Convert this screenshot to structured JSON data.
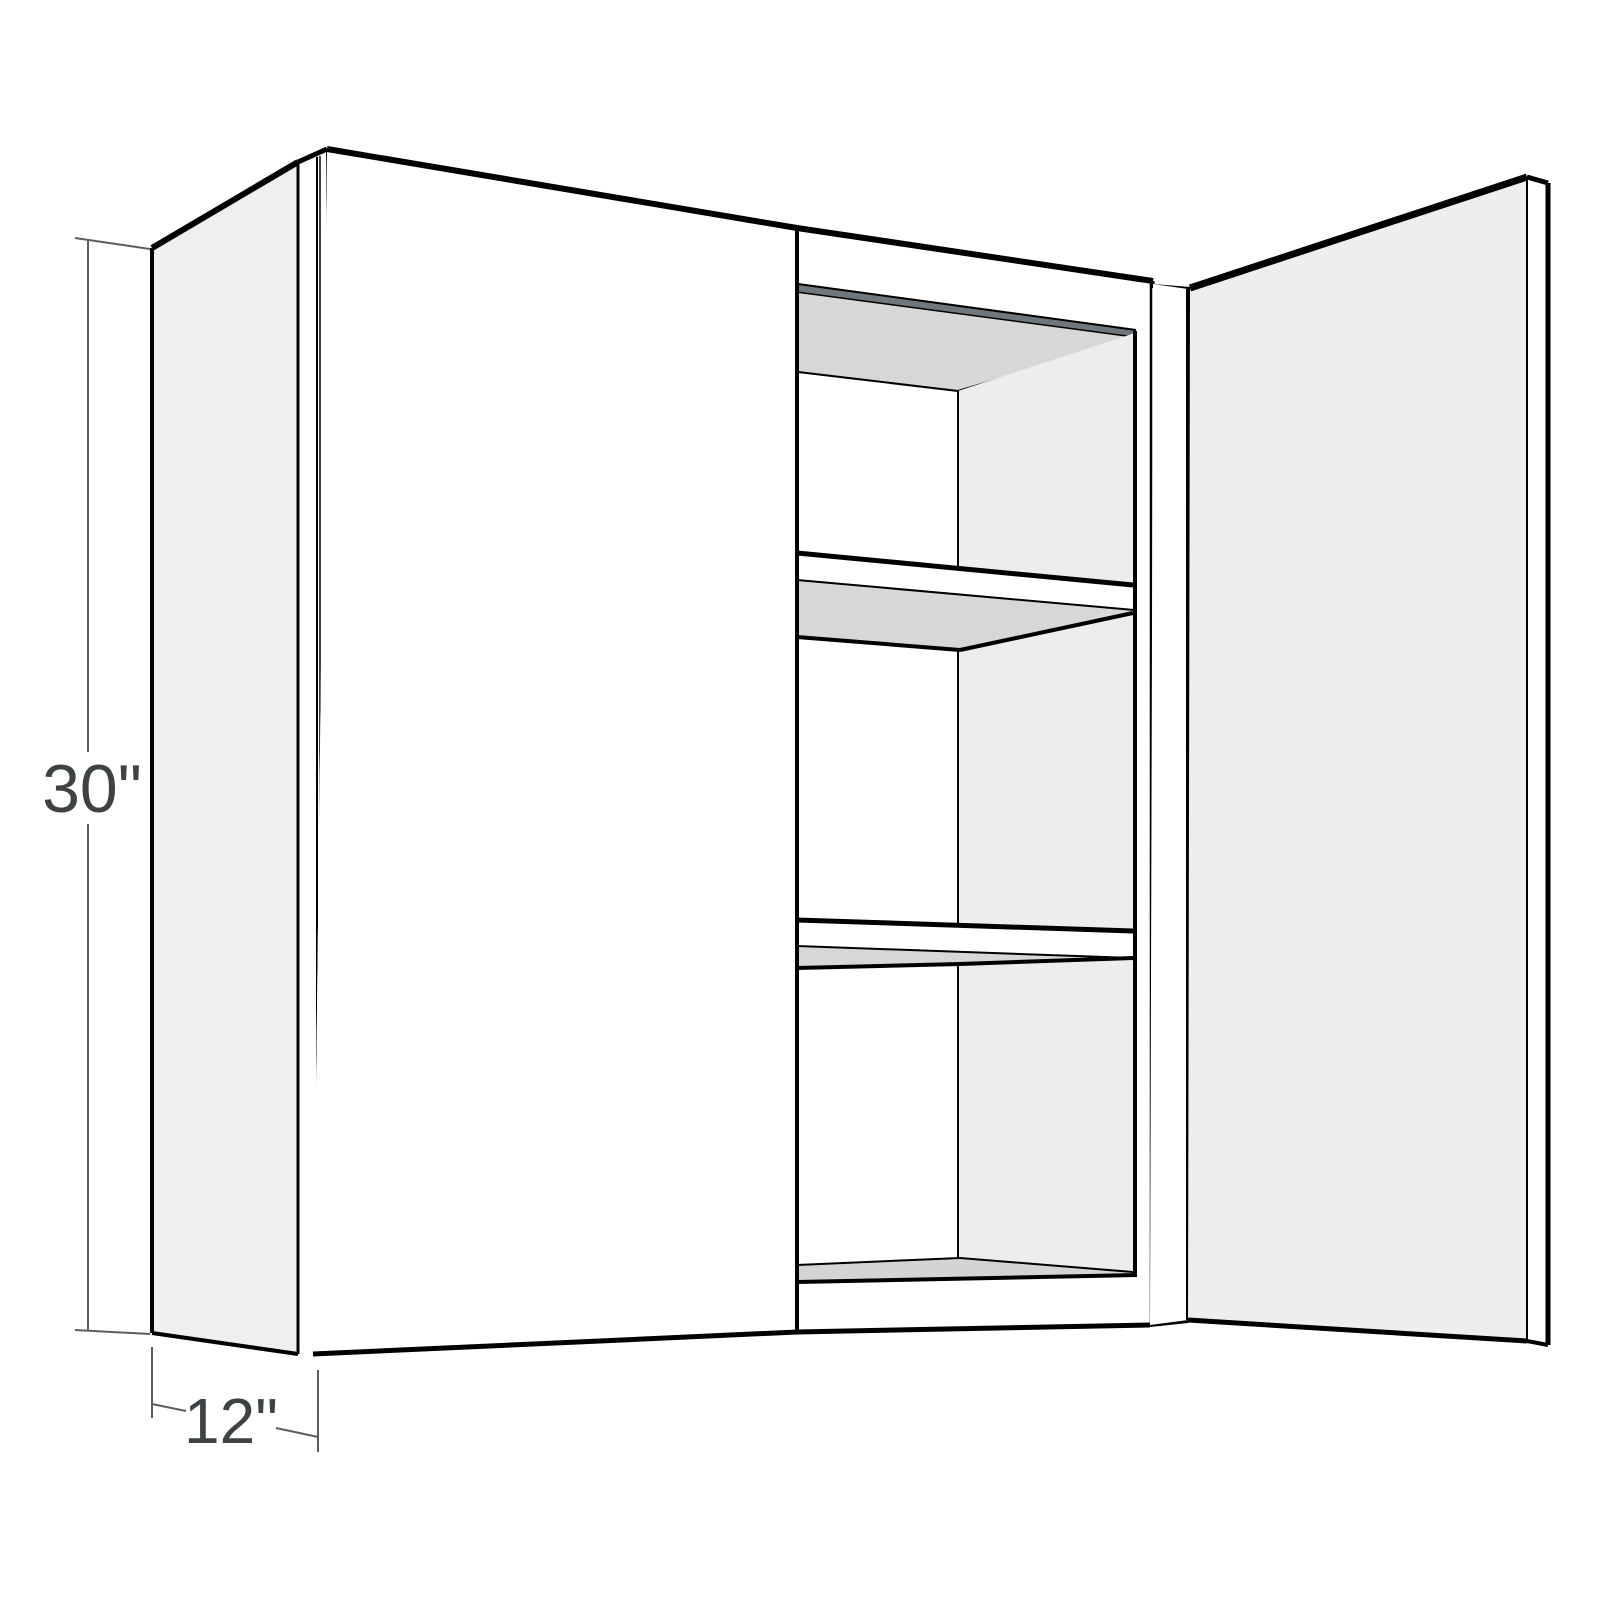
{
  "dimensions": {
    "height": {
      "label": "30\""
    },
    "depth": {
      "label": "12\""
    }
  },
  "colors": {
    "background": "#ffffff",
    "line": "#000000",
    "dimension_line": "#5a5e61",
    "dimension_text": "#3d4245",
    "panel_light": "#efefef",
    "door_face": "#ffffff",
    "open_door_face": "#eeeeef",
    "interior_wall": "#ededee",
    "surface_shadow": "#d7d7d7",
    "floor_shadow": "#d4d4d4",
    "top_rail_dark": "#70777c"
  }
}
